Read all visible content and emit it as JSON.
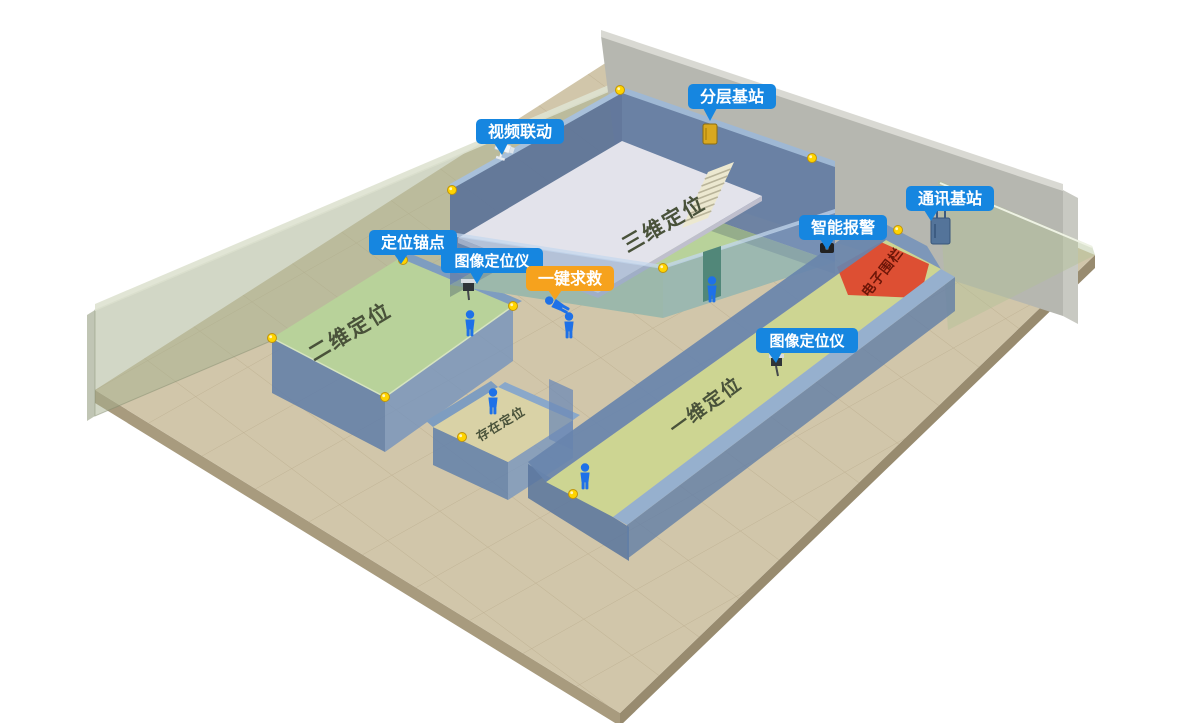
{
  "badges": {
    "layered_base_station": {
      "text": "分层基站"
    },
    "video_linkage": {
      "text": "视频联动"
    },
    "communication_base_station": {
      "text": "通讯基站"
    },
    "smart_alarm": {
      "text": "智能报警"
    },
    "positioning_anchor": {
      "text": "定位锚点"
    },
    "image_locator_1": {
      "text": "图像定位仪"
    },
    "image_locator_2": {
      "text": "图像定位仪"
    },
    "sos": {
      "text": "一键求救"
    }
  },
  "zones": {
    "three_d": {
      "label": "三维定位"
    },
    "two_d": {
      "label": "二维定位"
    },
    "presence": {
      "label": "存在定位"
    },
    "one_d": {
      "label": "一维定位"
    },
    "electronic_fence": {
      "label": "电子围栏"
    }
  },
  "colors": {
    "badge_blue": "#1686e0",
    "badge_orange": "#f6a21d",
    "fence_red": "#dd4f33",
    "room_floor_green": "#b8d29a",
    "corridor_floor": "#cdd592",
    "presence_floor": "#d9d2a6",
    "anchor_yellow": "#ffd400",
    "person_blue": "#1e71e8"
  }
}
